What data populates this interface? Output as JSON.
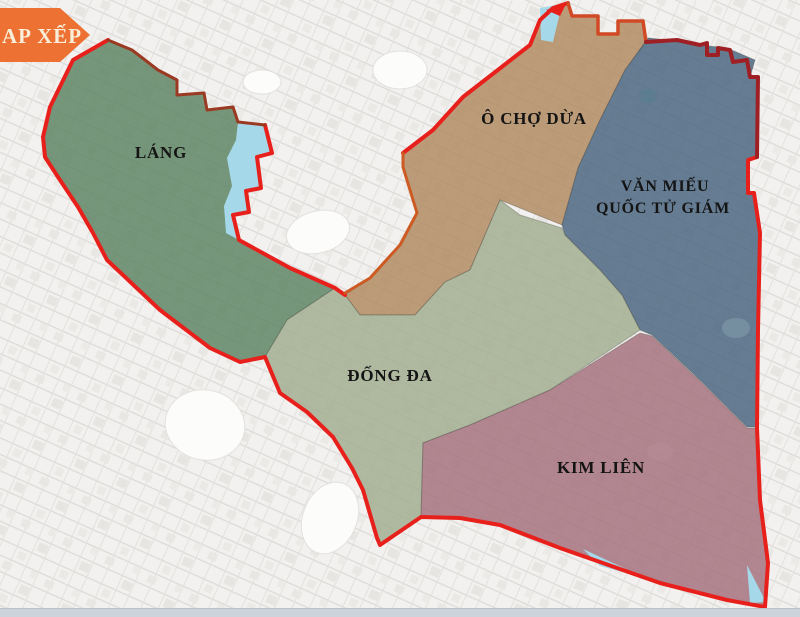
{
  "banner": {
    "label": "AP XẾP",
    "bg": "#ed7132",
    "text_color": "#f9eed9"
  },
  "map": {
    "title": "Map of merged wards (Hanoi) with district boundary overlay",
    "regions": [
      {
        "id": "lang",
        "label": "LÁNG",
        "color": "#5d8463"
      },
      {
        "id": "o-cho-dua",
        "label": "Ô CHỢ DỪA",
        "color": "#b08a61"
      },
      {
        "id": "van-mieu",
        "label": "VĂN MIẾU QUỐC TỬ GIÁM",
        "label_lines": [
          "VĂN MIẾU",
          "QUỐC TỬ GIÁM"
        ],
        "color": "#4a6580"
      },
      {
        "id": "dong-da",
        "label": "ĐỐNG ĐA",
        "color": "#a2ae90"
      },
      {
        "id": "kim-lien",
        "label": "KIM LIÊN",
        "color": "#a4717d"
      }
    ],
    "water_color": "#a5d9ea",
    "boundary_colors": {
      "outer": "#e8201c",
      "dark_red": "#9e1f24",
      "brick": "#9a3a22",
      "orange": "#cc5a22"
    }
  },
  "footer": {
    "strip_color": "#ccd3da"
  }
}
